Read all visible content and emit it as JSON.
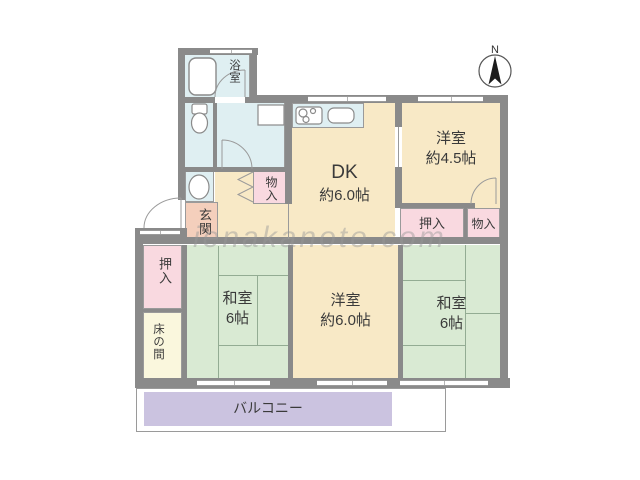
{
  "compass": {
    "label": "N"
  },
  "watermark": {
    "text": "ienakanote.com"
  },
  "rooms": {
    "bathroom": {
      "label": "浴室"
    },
    "dk": {
      "name": "DK",
      "size": "約6.0帖"
    },
    "western_room_ne": {
      "name": "洋室",
      "size": "約4.5帖"
    },
    "closet_oshiire_ne": {
      "label": "押入"
    },
    "closet_monoire_ne": {
      "label": "物入"
    },
    "closet_monoire_hall": {
      "label": "物入"
    },
    "entrance": {
      "label": "玄関"
    },
    "closet_oshiire_w": {
      "label": "押入"
    },
    "tokonoma": {
      "label": "床の間"
    },
    "japanese_room_sw": {
      "name": "和室",
      "size": "6帖"
    },
    "western_room_s": {
      "name": "洋室",
      "size": "約6.0帖"
    },
    "japanese_room_se": {
      "name": "和室",
      "size": "6帖"
    },
    "balcony": {
      "label": "バルコニー"
    }
  },
  "colors": {
    "wall": "#8a8a8a",
    "room_cream": "#f8e9c6",
    "tatami_green": "#d9ead3",
    "closet_pink": "#f9d9e0",
    "entrance_salmon": "#f4cfbc",
    "wet_area_blue": "#dfeff2",
    "balcony_lavender": "#cbc3e0",
    "tokonoma_cream": "#faf7dd",
    "watermark_gray": "#c9c9c9"
  }
}
